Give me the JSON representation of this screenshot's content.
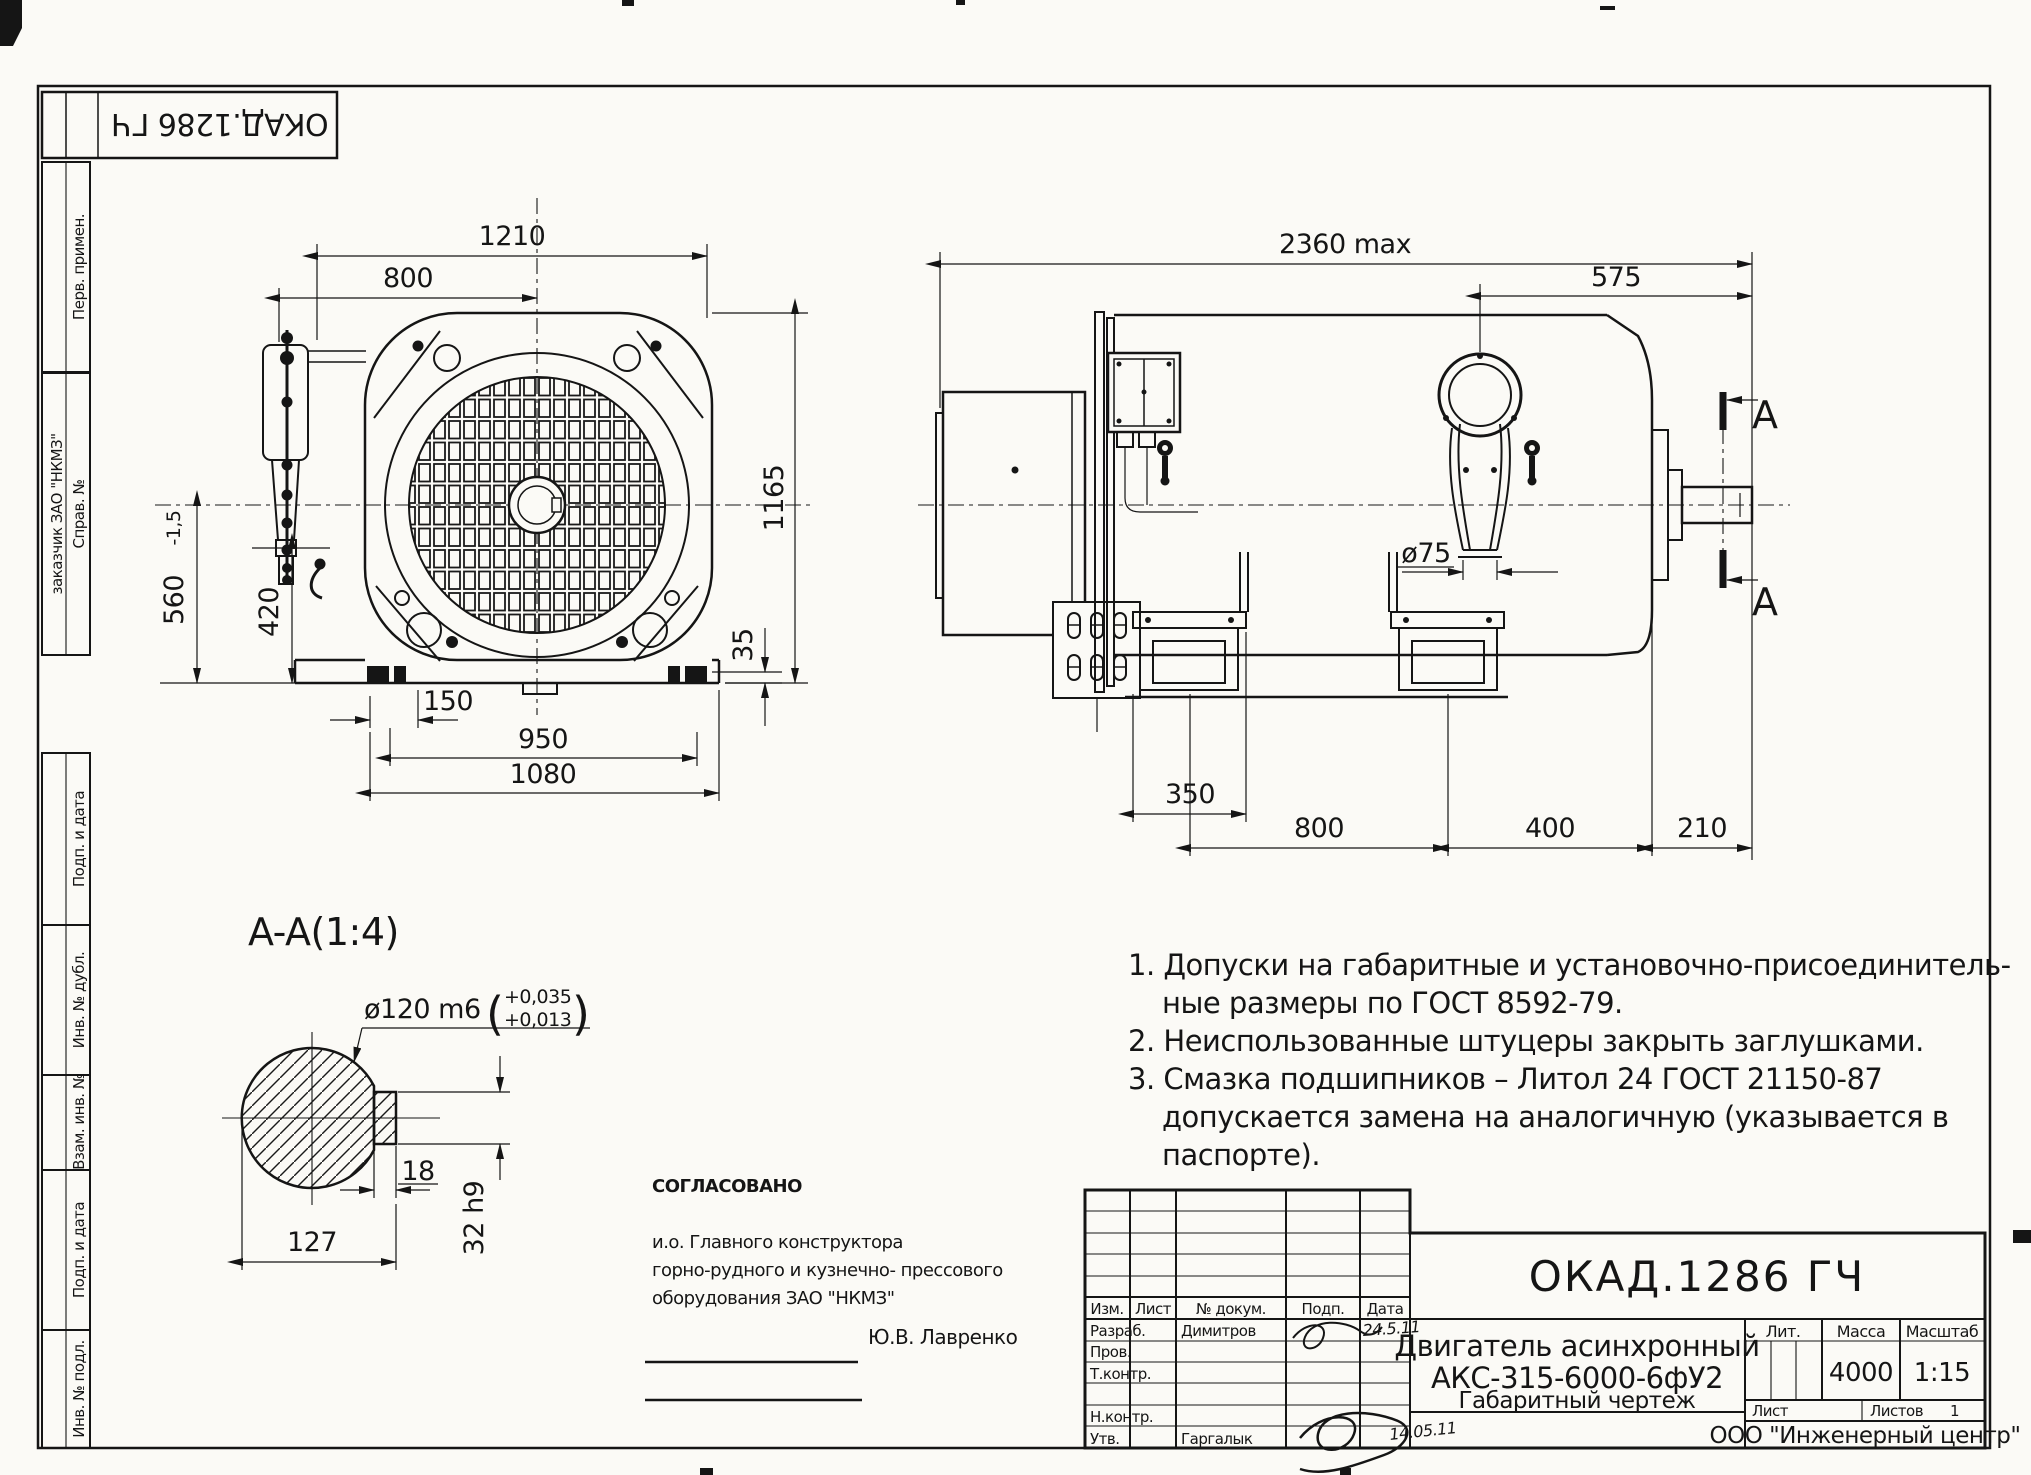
{
  "accent_color": "#151515",
  "paper_color": "#fbfaf6",
  "stamp": {
    "code": "ОКАД.1286 ГЧ"
  },
  "sidebar": {
    "items": [
      {
        "label": "Перв. примен."
      },
      {
        "label": "Справ. №"
      },
      {
        "label": "заказчик ЗАО \"НКМЗ\""
      },
      {
        "label": "Подп. и дата"
      },
      {
        "label": "Инв. № дубл."
      },
      {
        "label": "Взам. инв. №"
      },
      {
        "label": "Подп. и дата"
      },
      {
        "label": "Инв. № подл."
      }
    ]
  },
  "front_view": {
    "dims": {
      "d1210": "1210",
      "d800": "800",
      "d1165": "1165",
      "d560": "560",
      "d560tol": "-1,5",
      "d420": "420",
      "d35": "35",
      "d150": "150",
      "d950": "950",
      "d1080": "1080"
    }
  },
  "side_view": {
    "section_marker": "A",
    "dims": {
      "d2360": "2360 max",
      "d575": "575",
      "d75": "ø75",
      "d350": "350",
      "d800": "800",
      "d400": "400",
      "d210": "210"
    }
  },
  "section_view": {
    "title": "A-A(1:4)",
    "dims": {
      "dia": "ø120 m6",
      "paren_open": "(",
      "paren_close": ")",
      "tol_upper": "+0,035",
      "tol_lower": "+0,013",
      "key_width": "18",
      "key_height": "32 h9",
      "width": "127"
    }
  },
  "notes": {
    "lines": [
      "1. Допуски на габаритные и установочно-присоединитель-",
      "ные размеры по ГОСТ 8592-79.",
      "2. Неиспользованные штуцеры закрыть заглушками.",
      "3. Смазка подшипников – Литол 24 ГОСТ 21150-87",
      "допускается замена на аналогичную (указывается в",
      "паспорте)."
    ]
  },
  "approval": {
    "heading": "СОГЛАСОВАНО",
    "line1": "и.о. Главного конструктора",
    "line2": "горно-рудного и кузнечно- прессового",
    "line3": "оборудования ЗАО \"НКМЗ\"",
    "signer": "Ю.В. Лавренко"
  },
  "title_block": {
    "doc_code": "ОКАД.1286 ГЧ",
    "product_name_line1": "Двигатель асинхронный",
    "product_name_line2": "АКС-315-6000-6фУ2",
    "doc_type": "Габаритный чертеж",
    "headers": {
      "izm": "Изм.",
      "list": "Лист",
      "n_dokum": "№ докум.",
      "podp": "Подп.",
      "data": "Дата"
    },
    "rows": {
      "razrab": "Разраб.",
      "prov": "Пров.",
      "tkontr": "Т.контр.",
      "nkontr": "Н.контр.",
      "utv": "Утв."
    },
    "razrab_name": "Димитров",
    "razrab_date": "24.5.11",
    "utv_name": "Гаргалык",
    "utv_date": "14.05.11",
    "lit_label": "Лит.",
    "massa_label": "Масса",
    "masshtab_label": "Масштаб",
    "massa_value": "4000",
    "masshtab_value": "1:15",
    "list_label": "Лист",
    "listov_label": "Листов",
    "listov_value": "1",
    "company": "ООО \"Инженерный центр\""
  }
}
